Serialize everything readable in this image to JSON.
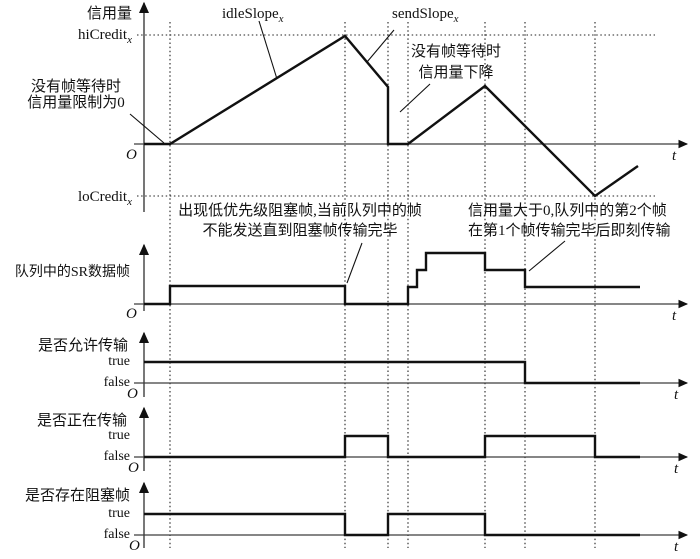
{
  "figure": "credit-based-shaper-timing-diagram",
  "colors": {
    "ink": "#111111",
    "axis": "#3d3d3d",
    "dotted": "#222222",
    "bg": "#ffffff"
  },
  "labels": {
    "credit_axis": "信用量",
    "hi_credit": {
      "base": "hiCredit",
      "sub": "x"
    },
    "lo_credit": {
      "base": "loCredit",
      "sub": "x"
    },
    "idle_slope": {
      "base": "idleSlope",
      "sub": "x"
    },
    "send_slope": {
      "base": "sendSlope",
      "sub": "x"
    },
    "origin": "O",
    "time": "t",
    "true_value": "true",
    "false_value": "false",
    "no_frame_limit_line1": "没有帧等待时",
    "no_frame_limit_line2": "信用量限制为0",
    "credit_drop_line1": "没有帧等待时",
    "credit_drop_line2": "信用量下降",
    "queue_panel": "队列中的SR数据帧",
    "allow_panel": "是否允许传输",
    "transmitting_panel": "是否正在传输",
    "blocking_panel": "是否存在阻塞帧",
    "blocking_note_line1": "出现低优先级阻塞帧,当前队列中的帧",
    "blocking_note_line2": "不能发送直到阻塞帧传输完毕",
    "credit_positive_note_line1": "信用量大于0,队列中的第2个帧",
    "credit_positive_note_line2": "在第1个帧传输完毕后即刻传输"
  },
  "geometry": {
    "width": 700,
    "height": 559,
    "grid_vlines": {
      "xs": [
        170,
        345,
        388,
        408,
        485,
        525,
        595
      ],
      "y1": 22,
      "y2": 548
    },
    "grid_hlines": [
      {
        "name": "hiCredit-level",
        "y": 35,
        "x1": 137,
        "x2": 655
      },
      {
        "name": "loCredit-level",
        "y": 196,
        "x1": 137,
        "x2": 655
      }
    ],
    "axes": [
      {
        "name": "credit",
        "ox": 144,
        "zero_y": 144,
        "top_y": 3,
        "bottom_y": 212,
        "right_x": 687
      },
      {
        "name": "queue",
        "ox": 144,
        "zero_y": 304,
        "top_y": 245,
        "bottom_y": 311,
        "right_x": 687
      },
      {
        "name": "allow",
        "ox": 144,
        "zero_y": 383,
        "top_y": 333,
        "bottom_y": 397,
        "right_x": 687
      },
      {
        "name": "transmitting",
        "ox": 144,
        "zero_y": 457,
        "top_y": 408,
        "bottom_y": 471,
        "right_x": 687
      },
      {
        "name": "blocking",
        "ox": 144,
        "zero_y": 535,
        "top_y": 483,
        "bottom_y": 548,
        "right_x": 687
      }
    ],
    "waveforms": [
      {
        "name": "credit-curve",
        "points": [
          [
            144,
            144
          ],
          [
            170,
            144
          ],
          [
            345,
            36
          ],
          [
            388,
            87
          ],
          [
            388,
            144
          ],
          [
            408,
            144
          ],
          [
            485,
            86
          ],
          [
            595,
            196
          ],
          [
            638,
            166
          ]
        ]
      },
      {
        "name": "queue-frames",
        "points": [
          [
            144,
            304
          ],
          [
            170,
            304
          ],
          [
            170,
            286
          ],
          [
            345,
            286
          ],
          [
            345,
            304
          ],
          [
            408,
            304
          ],
          [
            408,
            287
          ],
          [
            417,
            287
          ],
          [
            417,
            270
          ],
          [
            426,
            270
          ],
          [
            426,
            253
          ],
          [
            485,
            253
          ],
          [
            485,
            270
          ],
          [
            525,
            270
          ],
          [
            525,
            287
          ],
          [
            640,
            287
          ]
        ]
      },
      {
        "name": "allow-signal",
        "points": [
          [
            144,
            362
          ],
          [
            525,
            362
          ],
          [
            525,
            383
          ],
          [
            640,
            383
          ]
        ]
      },
      {
        "name": "transmitting-signal",
        "points": [
          [
            144,
            457
          ],
          [
            345,
            457
          ],
          [
            345,
            436
          ],
          [
            388,
            436
          ],
          [
            388,
            457
          ],
          [
            485,
            457
          ],
          [
            485,
            436
          ],
          [
            595,
            436
          ],
          [
            595,
            457
          ],
          [
            640,
            457
          ]
        ]
      },
      {
        "name": "blocking-signal",
        "points": [
          [
            144,
            514
          ],
          [
            345,
            514
          ],
          [
            345,
            535
          ],
          [
            388,
            535
          ],
          [
            388,
            514
          ],
          [
            485,
            514
          ],
          [
            485,
            535
          ],
          [
            640,
            535
          ]
        ]
      }
    ],
    "pointers": [
      {
        "name": "idle-slope-pointer",
        "x1": 259,
        "y1": 21,
        "x2": 277,
        "y2": 79
      },
      {
        "name": "send-slope-pointer",
        "x1": 394,
        "y1": 30,
        "x2": 367,
        "y2": 62
      },
      {
        "name": "credit-drop-pointer",
        "x1": 430,
        "y1": 84,
        "x2": 400,
        "y2": 112
      },
      {
        "name": "no-frame-limit-pointer",
        "x1": 130,
        "y1": 114,
        "x2": 164,
        "y2": 143
      },
      {
        "name": "blocking-note-pointer",
        "x1": 362,
        "y1": 243,
        "x2": 347,
        "y2": 283
      },
      {
        "name": "credit-positive-pointer",
        "x1": 565,
        "y1": 241,
        "x2": 529,
        "y2": 271
      }
    ]
  }
}
